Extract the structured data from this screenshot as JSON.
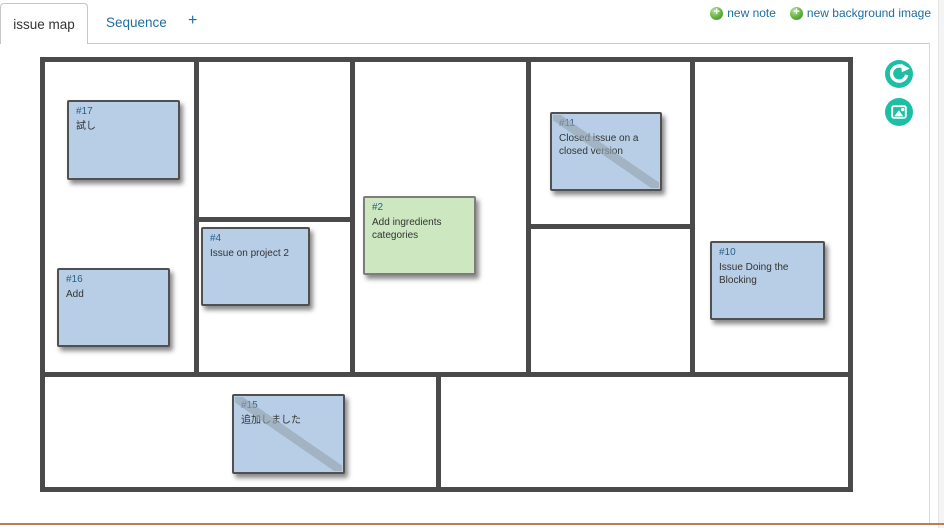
{
  "tabs": {
    "active": "issue map",
    "sequence": "Sequence",
    "add": "+"
  },
  "actions": {
    "new_note": "new note",
    "new_background_image": "new background image"
  },
  "icons": {
    "add": "green-plus-circle",
    "refresh": "teal-refresh-arrow-circle",
    "background_image": "teal-picture-circle"
  },
  "colors": {
    "link": "#1e6da0",
    "accent_teal": "#1cbfa4",
    "tab_border": "#c5c5c5",
    "board_border": "#4a4a4a",
    "note_blue_bg": "#b7cee6",
    "note_blue_border": "#505050",
    "note_green_bg": "#cde8c0",
    "note_green_border": "#7d7d7d",
    "note_id": "#2c5e8a",
    "note_text": "#333333",
    "closed_stripe": "#96a3ae",
    "footer_line": "#c07a58"
  },
  "board": {
    "notes": [
      {
        "id": "#17",
        "text": "試し",
        "color": "blue",
        "closed": false,
        "x": 67,
        "y": 100,
        "w": 113,
        "h": 80
      },
      {
        "id": "#16",
        "text": "Add",
        "color": "blue",
        "closed": false,
        "x": 57,
        "y": 268,
        "w": 113,
        "h": 79
      },
      {
        "id": "#4",
        "text": "Issue on project 2",
        "color": "blue",
        "closed": false,
        "x": 201,
        "y": 227,
        "w": 109,
        "h": 79
      },
      {
        "id": "#2",
        "text": "Add ingredients categories",
        "color": "green",
        "closed": false,
        "x": 363,
        "y": 196,
        "w": 113,
        "h": 79
      },
      {
        "id": "#11",
        "text": "Closed issue on a closed version",
        "color": "blue",
        "closed": true,
        "x": 550,
        "y": 112,
        "w": 112,
        "h": 79
      },
      {
        "id": "#10",
        "text": "Issue Doing the Blocking",
        "color": "blue",
        "closed": false,
        "x": 710,
        "y": 241,
        "w": 115,
        "h": 79
      },
      {
        "id": "#15",
        "text": "追加しました",
        "color": "blue",
        "closed": true,
        "x": 232,
        "y": 394,
        "w": 113,
        "h": 80
      }
    ]
  }
}
